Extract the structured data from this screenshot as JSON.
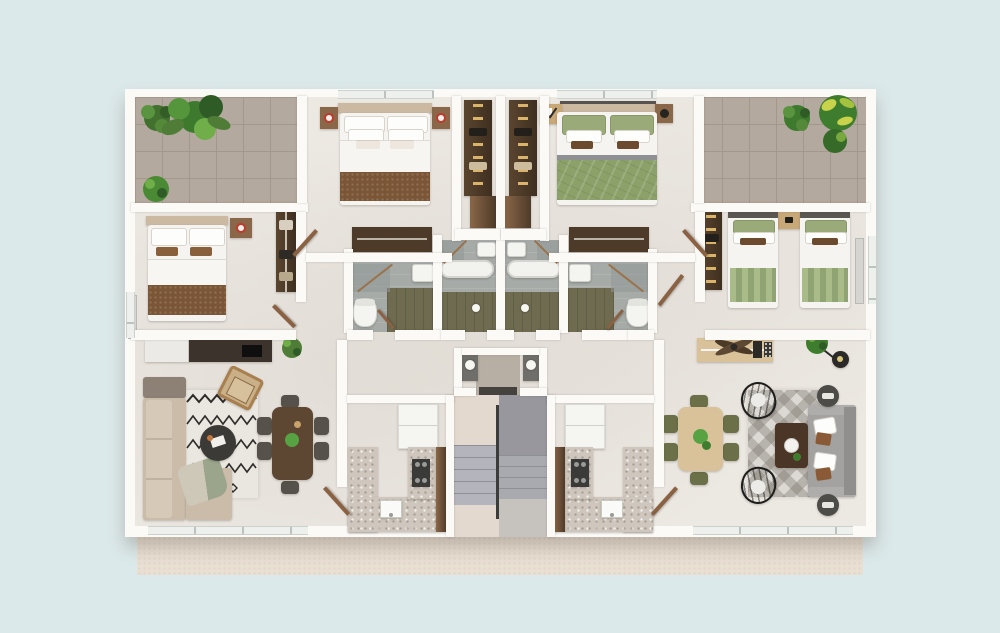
{
  "scene": {
    "type": "3d-floor-plan-top-down-render",
    "description": "Two mirrored apartments sharing a central staircase, rendered as a 3D top view on a plain background with a beige plinth below the building",
    "dimensions": {
      "width": 1000,
      "height": 633
    }
  },
  "palette": {
    "bg": "#dce9ea",
    "plinth": "#e9dfd3",
    "wall": "#fbfaf7",
    "floor": "#ece8e2",
    "terrace": "#b4a99e",
    "terraceLine": "#a3988c",
    "bathTile": "#a6aba8",
    "bathFloor": "#6e6b50",
    "woodDark": "#4e3a29",
    "woodMid": "#8a6748",
    "woodLight": "#d9c29a",
    "headboard": "#cbb9a2",
    "white": "#f6f4f0",
    "blanketBrown": "#7a5637",
    "cushionBrown": "#8a5f3c",
    "duvetGreen": "#8ba169",
    "pillowGreen": "#9aaa78",
    "stripeGreenA": "#a9bb88",
    "stripeGreenB": "#8fa472",
    "sofaBeige": "#cbbcaa",
    "sofaTaupe": "#8d8176",
    "sofaGray": "#a3a2a0",
    "pillowBrown": "#8a5a36",
    "rugCream": "#eae7e0",
    "rugInk": "#2e2c29",
    "rugGray": "#dcd9d4",
    "tableDark": "#3b3a37",
    "tableWood": "#5d4632",
    "chairGray": "#56524b",
    "oliveChair": "#6b7048",
    "granite": "#cfc7bd",
    "steel": "#3a3a38",
    "stairLight": "#e3d9cf",
    "stairTread": "#b4b5bc",
    "stairTreadEdge": "#8f9096",
    "stairDark": "#97979d",
    "stairDark2": "#a9a9b0",
    "rail": "#3c3c3a",
    "plantGreen": "#4f7d38",
    "plantLight": "#7fae4e",
    "plantDark": "#2f5c26",
    "crotonYellow": "#c8d24a",
    "lampRed": "#c0392b",
    "matDark": "#45413c",
    "fridgeWhite": "#f5f5f2",
    "radiator": "#d5d5d2",
    "doorWood": "#8a6243"
  },
  "rooms": [
    {
      "id": "terrace-left",
      "floor": "stone-tile",
      "contents": [
        "monstera-plant",
        "bush-plant",
        "round-bush"
      ]
    },
    {
      "id": "bedroom-small-left",
      "contents": [
        "double-bed-brown-blanket",
        "nightstand-lamp",
        "open-wardrobe",
        "radiator"
      ]
    },
    {
      "id": "bedroom-master-left",
      "contents": [
        "double-bed-brown-blanket",
        "nightstand-lamp-x2",
        "dresser-with-rail"
      ]
    },
    {
      "id": "walk-in-closet-left",
      "contents": [
        "clothes-rack",
        "bench"
      ]
    },
    {
      "id": "bathroom-inner-left",
      "contents": [
        "corner-shower",
        "sink",
        "bathtub",
        "olive-wood-floor"
      ]
    },
    {
      "id": "bathroom-outer-left",
      "contents": [
        "corner-shower",
        "sink",
        "toilet",
        "olive-wood-floor"
      ]
    },
    {
      "id": "kitchen-left",
      "contents": [
        "fridge-cabinet",
        "stove",
        "sink",
        "terrazzo-counter-L",
        "pantry-strip"
      ]
    },
    {
      "id": "living-dining-left",
      "contents": [
        "tv-console",
        "tv",
        "l-sofa-beige",
        "zigzag-rug",
        "round-coffee-table",
        "rattan-armchair",
        "dining-table-6-chairs",
        "potted-plant",
        "throw-blanket"
      ]
    },
    {
      "id": "entry-vestibule",
      "contents": [
        "doormat",
        "utility-counter-left",
        "utility-counter-right"
      ]
    },
    {
      "id": "staircase",
      "contents": [
        "up-flight",
        "down-flight",
        "center-rail"
      ]
    },
    {
      "id": "kitchen-right",
      "contents": [
        "fridge-cabinet",
        "stove",
        "sink",
        "terrazzo-counter-L",
        "pantry-strip"
      ]
    },
    {
      "id": "living-dining-right",
      "contents": [
        "sideboard",
        "ceiling-fan",
        "arc-floor-lamp",
        "dining-table-6-olive-chairs",
        "wire-chair-x2",
        "diamond-rug",
        "dark-coffee-table",
        "gray-sofa",
        "pouf-x2",
        "potted-plant"
      ]
    },
    {
      "id": "bathroom-inner-right",
      "contents": [
        "corner-shower",
        "sink",
        "bathtub",
        "olive-wood-floor"
      ]
    },
    {
      "id": "bathroom-outer-right",
      "contents": [
        "corner-shower",
        "sink",
        "toilet",
        "olive-wood-floor"
      ]
    },
    {
      "id": "walk-in-closet-right",
      "contents": [
        "clothes-rack",
        "bench"
      ]
    },
    {
      "id": "bedroom-master-right",
      "contents": [
        "double-bed-green-duvet",
        "desk",
        "nightstand",
        "dresser-with-rail"
      ]
    },
    {
      "id": "bedroom-twin-right",
      "contents": [
        "single-bed-green-stripes-x2",
        "shared-nightstand",
        "clothes-rack",
        "radiator"
      ]
    },
    {
      "id": "terrace-right",
      "contents": [
        "bush-plant",
        "croton-plant"
      ]
    }
  ]
}
